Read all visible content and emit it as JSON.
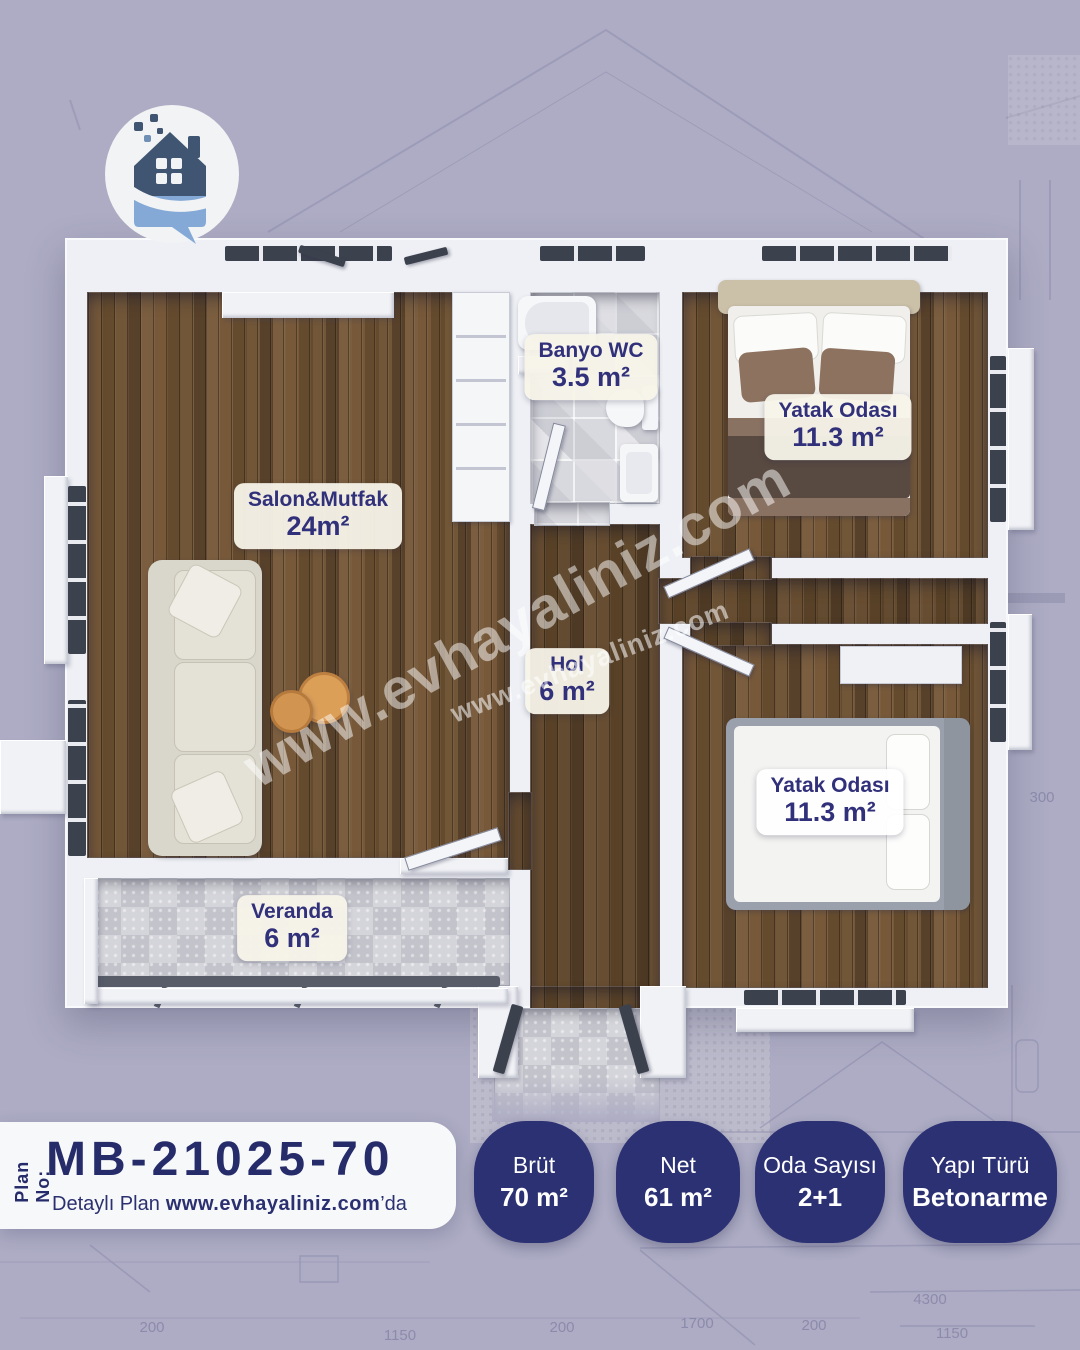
{
  "watermarks": {
    "large": "www.evhayaliniz.com",
    "small": "www.evhayaliniz.com"
  },
  "rooms": {
    "salon": {
      "name": "Salon&Mutfak",
      "area": "24m²"
    },
    "banyo": {
      "name": "Banyo WC",
      "area": "3.5 m²"
    },
    "yatak1": {
      "name": "Yatak Odası",
      "area": "11.3 m²"
    },
    "hol": {
      "name": "Hol",
      "area": "6 m²"
    },
    "yatak2": {
      "name": "Yatak Odası",
      "area": "11.3 m²"
    },
    "veranda": {
      "name": "Veranda",
      "area": "6 m²"
    }
  },
  "plan_bar": {
    "plan_no_label": "Plan No:",
    "plan_number": "MB-21025-70",
    "detail_text": "Detaylı Plan",
    "detail_site": "www.evhayaliniz.com",
    "detail_suffix": "’da"
  },
  "badges": [
    {
      "label": "Brüt",
      "value": "70 m²"
    },
    {
      "label": "Net",
      "value": "61 m²"
    },
    {
      "label": "Oda Sayısı",
      "value": "2+1"
    },
    {
      "label": "Yapı Türü",
      "value": "Betonarme"
    }
  ],
  "background": {
    "dims": [
      "200",
      "1150",
      "200",
      "1700",
      "200",
      "4300",
      "1150",
      "300"
    ]
  },
  "colors": {
    "background": "#adacc4",
    "accent_navy": "#2b3173",
    "wood": "#6b5134",
    "wall_white": "#f1f2f6"
  }
}
